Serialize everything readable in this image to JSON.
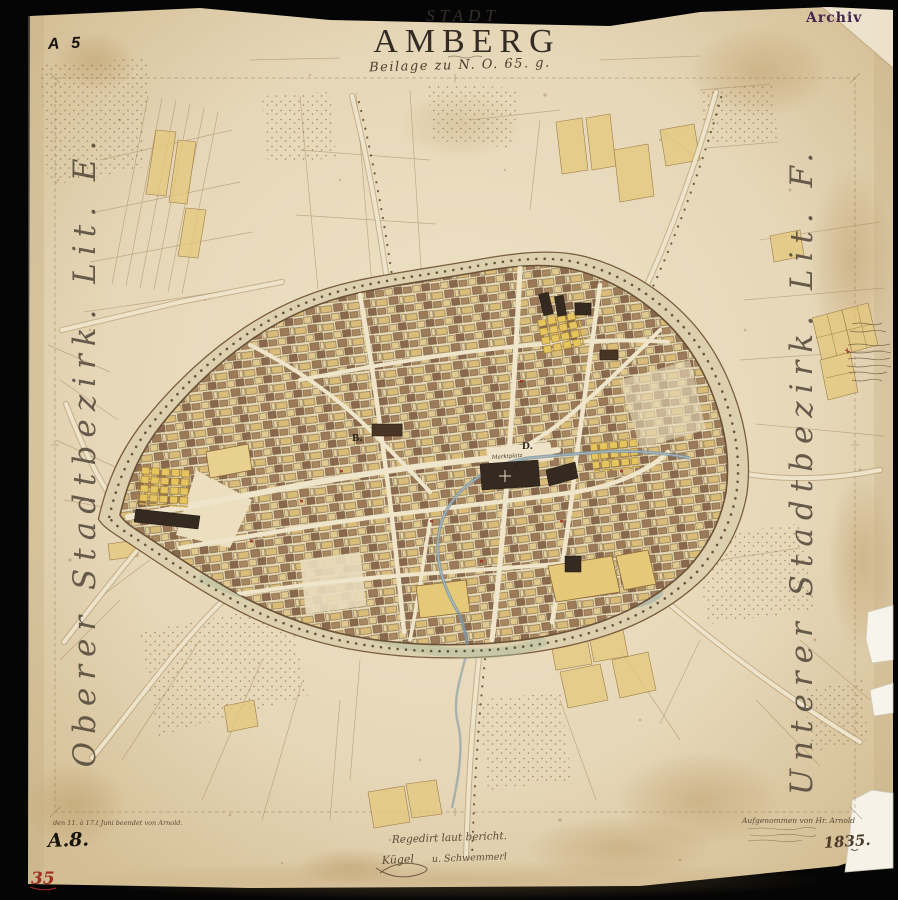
{
  "header": {
    "sheet_code": "A 5",
    "archive_stamp": "Archiv"
  },
  "title": {
    "kicker": "STADT",
    "name": "AMBERG",
    "subtitle": "Beilage zu N. O. 65. g."
  },
  "margins": {
    "left": "Oberer Stadtbezirk. Lit. E.",
    "right": "Unterer Stadtbezirk. Lit. F."
  },
  "map_labels": {
    "district_b": "B.",
    "district_c": "C.",
    "district_d": "D.",
    "market_square": "Marktplatz"
  },
  "footer": {
    "revision_note": "den 11. à 17.t Juni beendet von Arnold.",
    "sheet_ref": "A.8.",
    "approval_note": "Regedirt laut bericht.",
    "signature": "Kügel",
    "co_signature": "u. Schwemmerl",
    "survey_note": "Aufgenommen von Hr. Arnold",
    "year": "1835.",
    "archive_number": "35"
  },
  "colors": {
    "background": "#050505",
    "paper": "#e6d7b8",
    "paper_stain": "#c8a877",
    "ink": "#3b3228",
    "stamp_purple": "#45264e",
    "handwriting_red": "#a02c20",
    "field_yellow": "#e4c87c",
    "building_brown": "#8f6e50",
    "building_dark": "#352a1f",
    "water_blue": "#7f96a3",
    "moat_green": "#aebd9b"
  }
}
